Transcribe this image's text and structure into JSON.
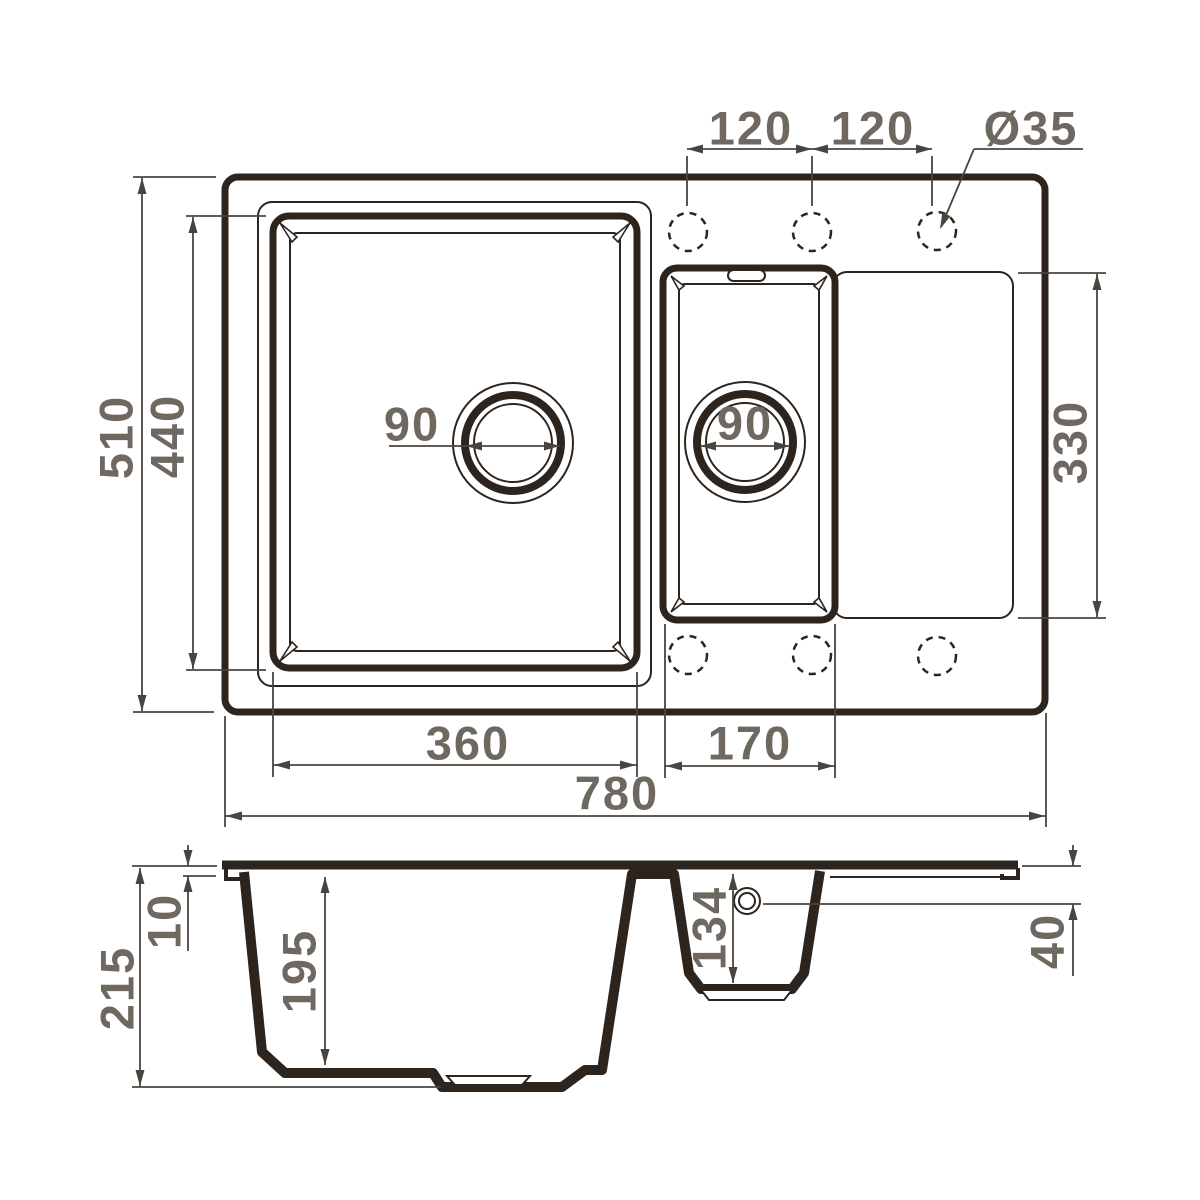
{
  "colors": {
    "outline": "#2d241d",
    "dimension_line": "#4a443e",
    "dimension_text": "#6e6861",
    "background": "#ffffff"
  },
  "top_view": {
    "dimensions": {
      "hole_pitch_left": "120",
      "hole_pitch_right": "120",
      "hole_diameter": "Ø35",
      "depth_overall": "510",
      "bowl_inner_depth": "440",
      "main_drain_diameter": "90",
      "small_drain_diameter": "90",
      "drainboard_length": "330",
      "main_bowl_width": "360",
      "small_bowl_width": "170",
      "width_overall": "780"
    }
  },
  "section_view": {
    "dimensions": {
      "height_overall": "215",
      "rim_thickness": "10",
      "main_bowl_depth": "195",
      "small_bowl_depth": "134",
      "drainboard_drop": "40"
    }
  }
}
